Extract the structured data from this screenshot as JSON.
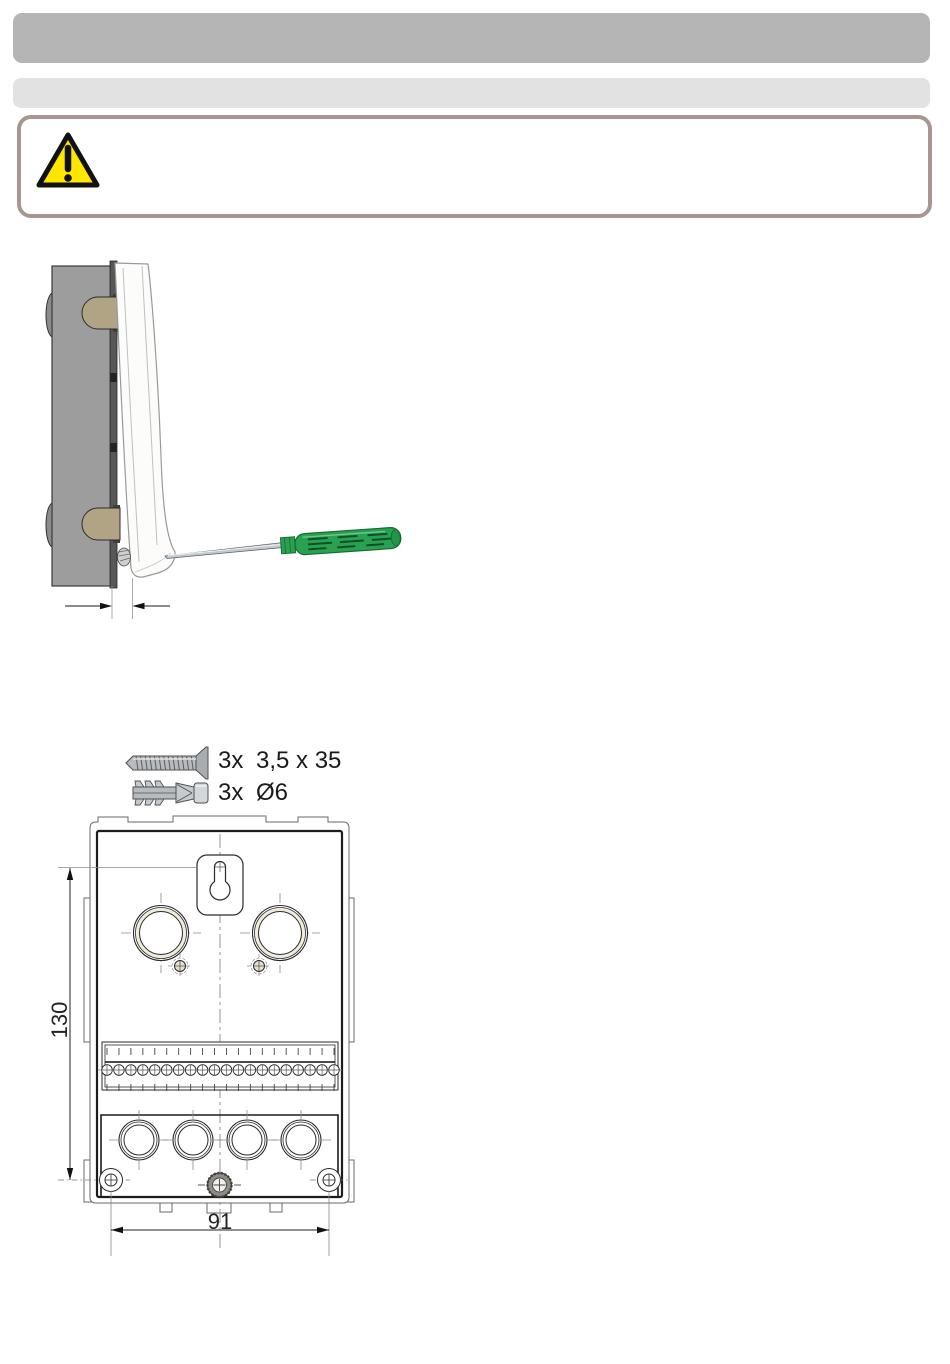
{
  "header": {
    "bar1_color": "#b5b5b5",
    "bar2_color": "#e2e2e2"
  },
  "warning": {
    "border_color": "#a89690",
    "triangle_fill": "#ffe600",
    "triangle_stroke": "#111111"
  },
  "figure_open_cover": {
    "box_color": "#9d9d9d",
    "hinge_color": "#b1a484",
    "screwdriver_handle_color": "#2aa150"
  },
  "hardware": {
    "screw": {
      "qty": "3x",
      "size": "3,5 x 35"
    },
    "plug": {
      "qty": "3x",
      "size": "Ø6"
    }
  },
  "drawing": {
    "height_dimension": "130",
    "width_dimension": "91",
    "terminal_count": 20,
    "upper_knockouts": 2,
    "lower_knockouts": 4,
    "bottom_screw_holes": 2
  }
}
